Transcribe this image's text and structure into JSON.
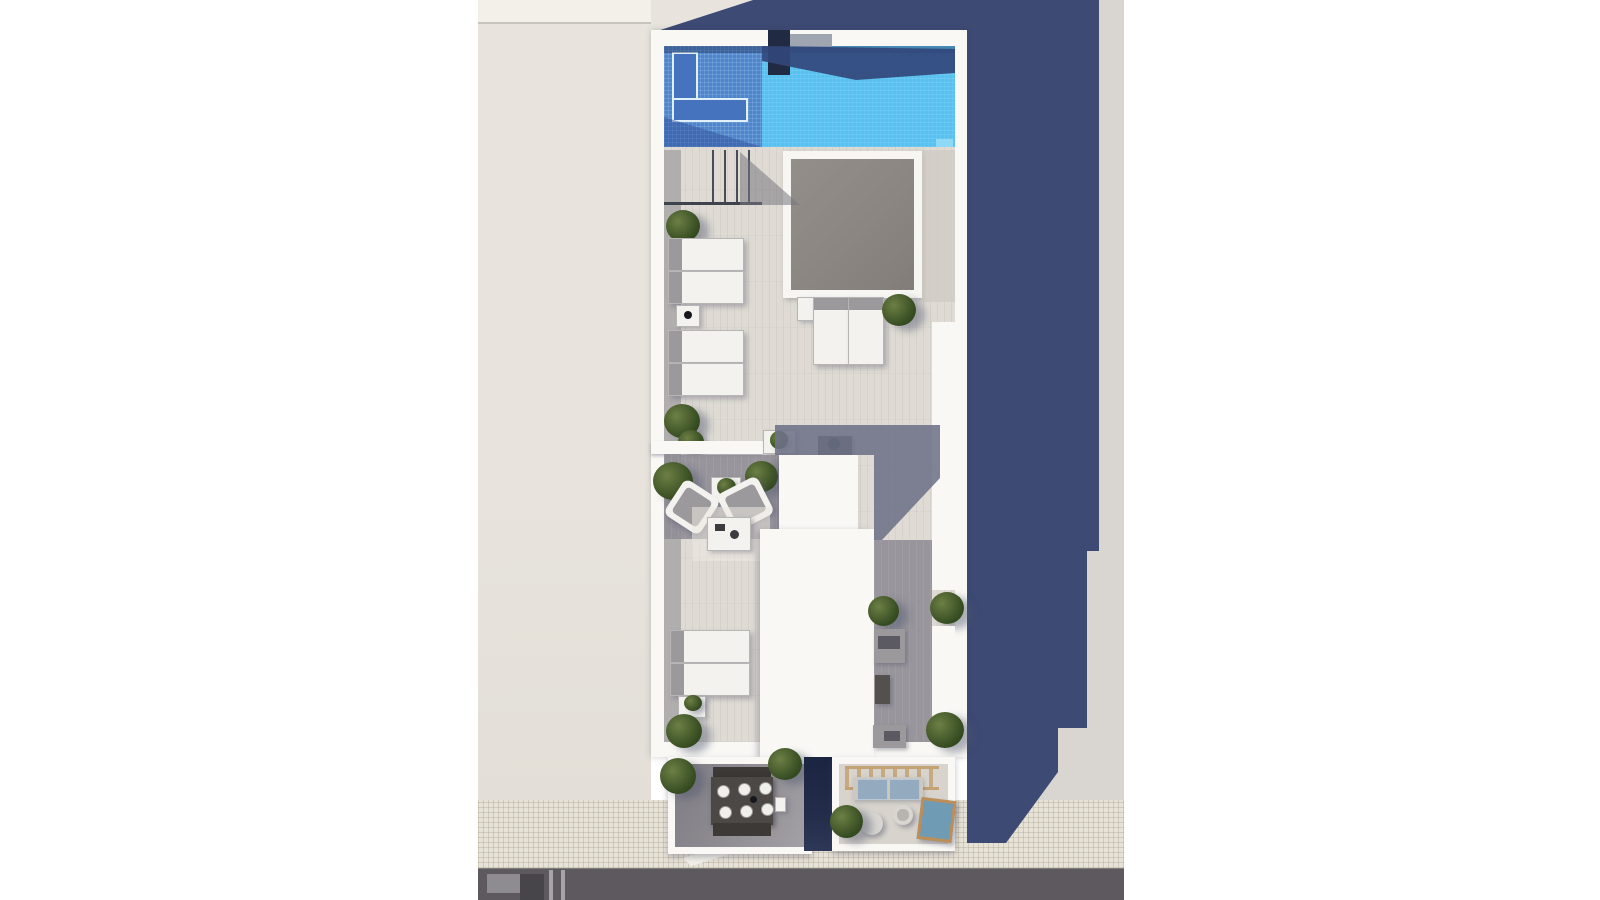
{
  "meta": {
    "render_type": "architectural-top-down-render",
    "subject": "rooftop solarium terrace with swimming pool, sun deck, lounge areas and two lower balconies over a street"
  },
  "palette": {
    "page_bg": "#ffffff",
    "neighbor_roof": "#e8e4dd",
    "neighbor_roof_light": "#f3f0ea",
    "neighbor_parapet_line": "#c8c3bb",
    "ground_gray": "#d9d6d1",
    "sidewalk": "#e7e2d8",
    "road": "#5d595e",
    "road_mark_light": "#8f8c91",
    "road_mark_dark": "#47444a",
    "wall_white": "#f9f8f5",
    "deck_light": "#dfdbd4",
    "deck_gray_zone": "#8f8c95",
    "deck_shadow_strip": "#a9a6a7",
    "deck_strip_right": "#cfcac3",
    "deck_shadow_band": "#6e7287",
    "big_shadow": "#3d4a74",
    "pool_water": "#57c1f1",
    "pool_tile": "#4e86cd",
    "pool_step": "#4573bd",
    "pool_shadow": "#32467b",
    "chimney": "#202a42",
    "chimney_ledge": "#9097a6",
    "skylight": "#8b8681",
    "skylight_frame": "#f7f6f3",
    "plant_dark": "#33491f",
    "plant_light": "#6c7f45",
    "lounger_white": "#f3f2ef",
    "lounger_frame": "#b8b6b4",
    "furniture_gray": "#9b999c",
    "table_dark": "#54504d",
    "dining_table": "#4b4845",
    "plate_white": "#f1efec",
    "balcony_floor_gray": "#8d8b90",
    "balcony_floor_light": "#d8d4cd",
    "void_dark": "#232d4a",
    "pergola_wood": "#c3a274",
    "sofa_cushion": "#93aabf",
    "lounger_wood": "#bd8e57",
    "lounger_cushion": "#6f9cb4",
    "pouf": "#d9d6d1"
  },
  "scene": {
    "areas": [
      {
        "name": "neighbor-building-roof",
        "side": "left"
      },
      {
        "name": "street",
        "elements": [
          "sidewalk-tiles",
          "asphalt-road",
          "lane-markings",
          "curb-ramp"
        ]
      },
      {
        "name": "rooftop-terrace",
        "elements": [
          "swimming-pool",
          "pool-steps",
          "pool-chimney",
          "pool-ladder-railing",
          "skylight",
          "sun-loungers",
          "side-tables",
          "planter-bushes",
          "divider-wall",
          "lounge-armchairs",
          "coffee-table",
          "stair-access-volumes",
          "planter-wall",
          "gray-benches"
        ]
      },
      {
        "name": "cast-shadow",
        "side": "right"
      },
      {
        "name": "left-balcony",
        "elements": [
          "dining-table",
          "dining-benches",
          "place-settings",
          "corner-plants"
        ]
      },
      {
        "name": "stairwell-void"
      },
      {
        "name": "right-balcony",
        "elements": [
          "pergola",
          "sofa-with-cushions",
          "poufs",
          "wooden-sun-lounger",
          "plant"
        ]
      }
    ]
  }
}
